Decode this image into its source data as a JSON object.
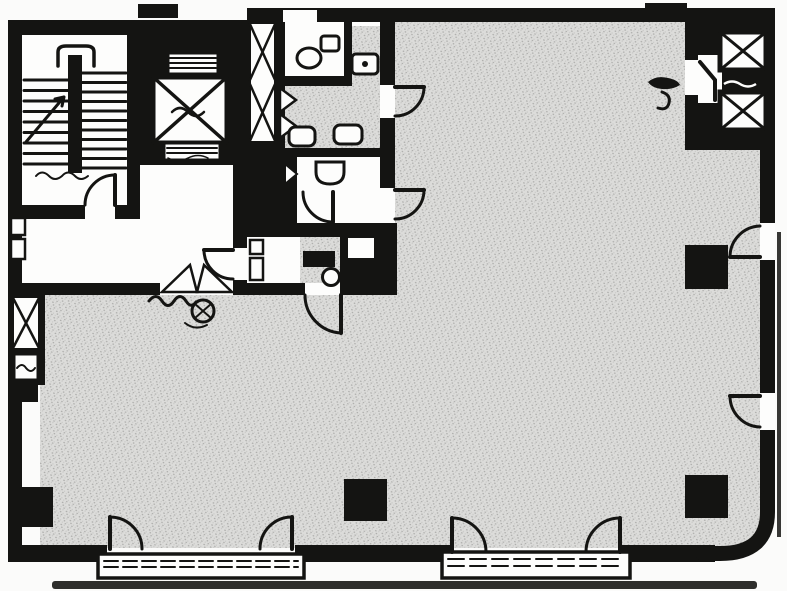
{
  "colors": {
    "ink": "#141412",
    "paper": "#fbfbfa",
    "room_white": "#fdfdfc",
    "floor_base": "#dcdcda",
    "speckle_dark": "#a8a8a6",
    "speckle_mid": "#c7c7c5",
    "scan_shadow": "#2e2e2c"
  },
  "plan": {
    "kind": "scanned-building-floor-plan",
    "legible_text": "",
    "areas": [
      {
        "name": "open-floor-area",
        "finish": "stippled"
      },
      {
        "name": "stairwell"
      },
      {
        "name": "main-elevator"
      },
      {
        "name": "right-elevator-bank",
        "elevators": 2
      },
      {
        "name": "elevator-hall"
      },
      {
        "name": "wc-room-north"
      },
      {
        "name": "washroom-circulation",
        "finish": "stippled"
      },
      {
        "name": "wc-room-south"
      },
      {
        "name": "service-room",
        "finish": "stippled"
      },
      {
        "name": "storage-room"
      },
      {
        "name": "kitchenette",
        "finish": "stippled"
      },
      {
        "name": "core-lobby"
      },
      {
        "name": "pipe-shaft-core"
      },
      {
        "name": "pipe-shaft-west"
      }
    ],
    "fixtures": [
      "toilet",
      "wash-basin",
      "sink",
      "urinal",
      "stair-treads",
      "handrail-loop",
      "call-panel"
    ],
    "symbols": {
      "elevator": "box-with-x",
      "door": "quarter-circle-swing",
      "column": "solid-black-square",
      "shaft": "box-with-x",
      "floor-finish": "stipple-noise"
    },
    "counts": {
      "columns": 3,
      "door_swings": 14,
      "street_entrances": 2,
      "elevator_cars": 3,
      "handwritten_scribbles": 4
    }
  }
}
